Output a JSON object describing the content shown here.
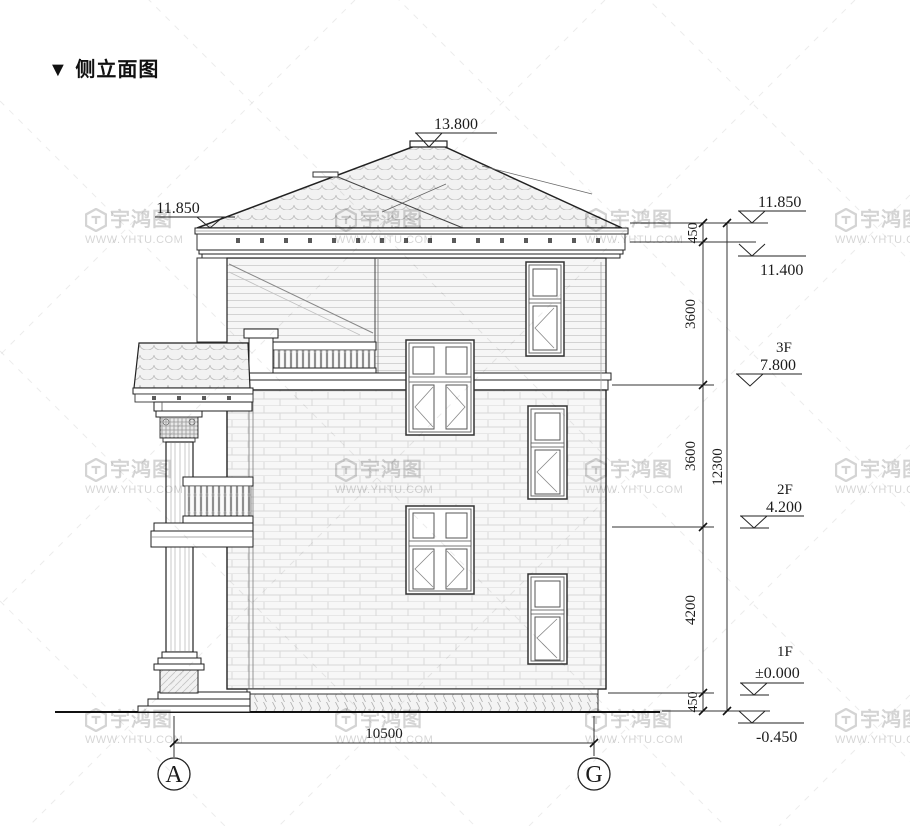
{
  "title": {
    "text": "▼ 侧立面图"
  },
  "watermark": {
    "brand": "宇鸿图",
    "url": "WWW.YHTU.COM"
  },
  "levels": {
    "roof_top": "13.800",
    "eave_left": "11.850",
    "eave_right": "11.850",
    "wall_top": "11.400",
    "floor3": {
      "label": "3F",
      "value": "7.800"
    },
    "floor2": {
      "label": "2F",
      "value": "4.200"
    },
    "floor1": {
      "label": "1F",
      "value": "±0.000"
    },
    "ground": "-0.450"
  },
  "dimensions": {
    "right_chain": [
      "450",
      "3600",
      "3600",
      "4200",
      "450"
    ],
    "total_height": "12300",
    "width": "10500"
  },
  "grid_axes": {
    "left": "A",
    "right": "G"
  }
}
